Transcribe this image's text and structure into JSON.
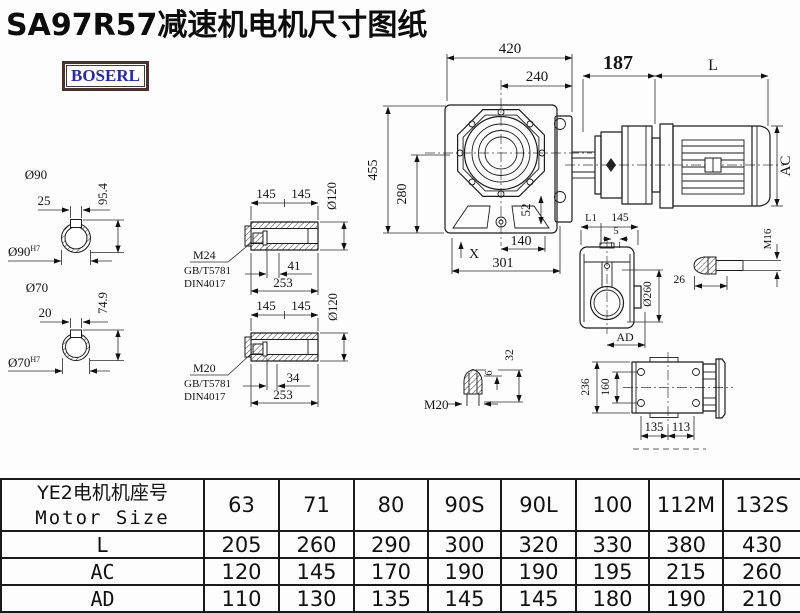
{
  "title": "SA97R57减速机电机尺寸图纸",
  "brand": {
    "logo_text": "BOSERL"
  },
  "front_view": {
    "width_total": "420",
    "width_face": "240",
    "flange_to_motor": "187",
    "motor_length": "L",
    "height_total": "455",
    "height_axis": "280",
    "offset_52": "52",
    "mark_x": "X",
    "base_140": "140",
    "base_301": "301",
    "motor_diameter": "AC"
  },
  "shaft_90": {
    "od_label": "Ø90",
    "key_w": "25",
    "key_h": "95.4",
    "bore_label": "Ø90",
    "bore_tol": "H7"
  },
  "shaft_70": {
    "od_label": "Ø70",
    "key_w": "20",
    "key_h": "74.9",
    "bore_label": "Ø70",
    "bore_tol": "H7"
  },
  "bushing_m24": {
    "len_left": "145",
    "len_right": "145",
    "od": "Ø120",
    "thread": "M24",
    "std_gb": "GB/T5781",
    "std_din": "DIN4017",
    "bolt_len": "41",
    "total_len": "253"
  },
  "bushing_m20": {
    "len_left": "145",
    "len_right": "145",
    "od": "Ø120",
    "thread": "M20",
    "std_gb": "GB/T5781",
    "std_din": "DIN4017",
    "bolt_len": "34",
    "total_len": "253"
  },
  "side_view": {
    "dim_l1": "L1",
    "dim_145": "145",
    "dim_5": "5",
    "od": "Ø260",
    "dim_ad": "AD"
  },
  "bolt_m16": {
    "thread": "M16",
    "len": "26"
  },
  "stud_m20": {
    "thread": "M20",
    "tip_h": "6",
    "len": "32"
  },
  "bottom_view": {
    "height": "236",
    "hole_span": "160",
    "len_a": "135",
    "len_b": "113"
  },
  "table": {
    "header_cn": "YE2电机机座号",
    "header_en": "Motor Size",
    "columns": [
      "63",
      "71",
      "80",
      "90S",
      "90L",
      "100",
      "112M",
      "132S"
    ],
    "rows": [
      {
        "label": "L",
        "values": [
          "205",
          "260",
          "290",
          "300",
          "320",
          "330",
          "380",
          "430"
        ]
      },
      {
        "label": "AC",
        "values": [
          "120",
          "145",
          "170",
          "190",
          "190",
          "195",
          "215",
          "260"
        ]
      },
      {
        "label": "AD",
        "values": [
          "110",
          "130",
          "135",
          "145",
          "145",
          "180",
          "190",
          "210"
        ]
      }
    ]
  }
}
